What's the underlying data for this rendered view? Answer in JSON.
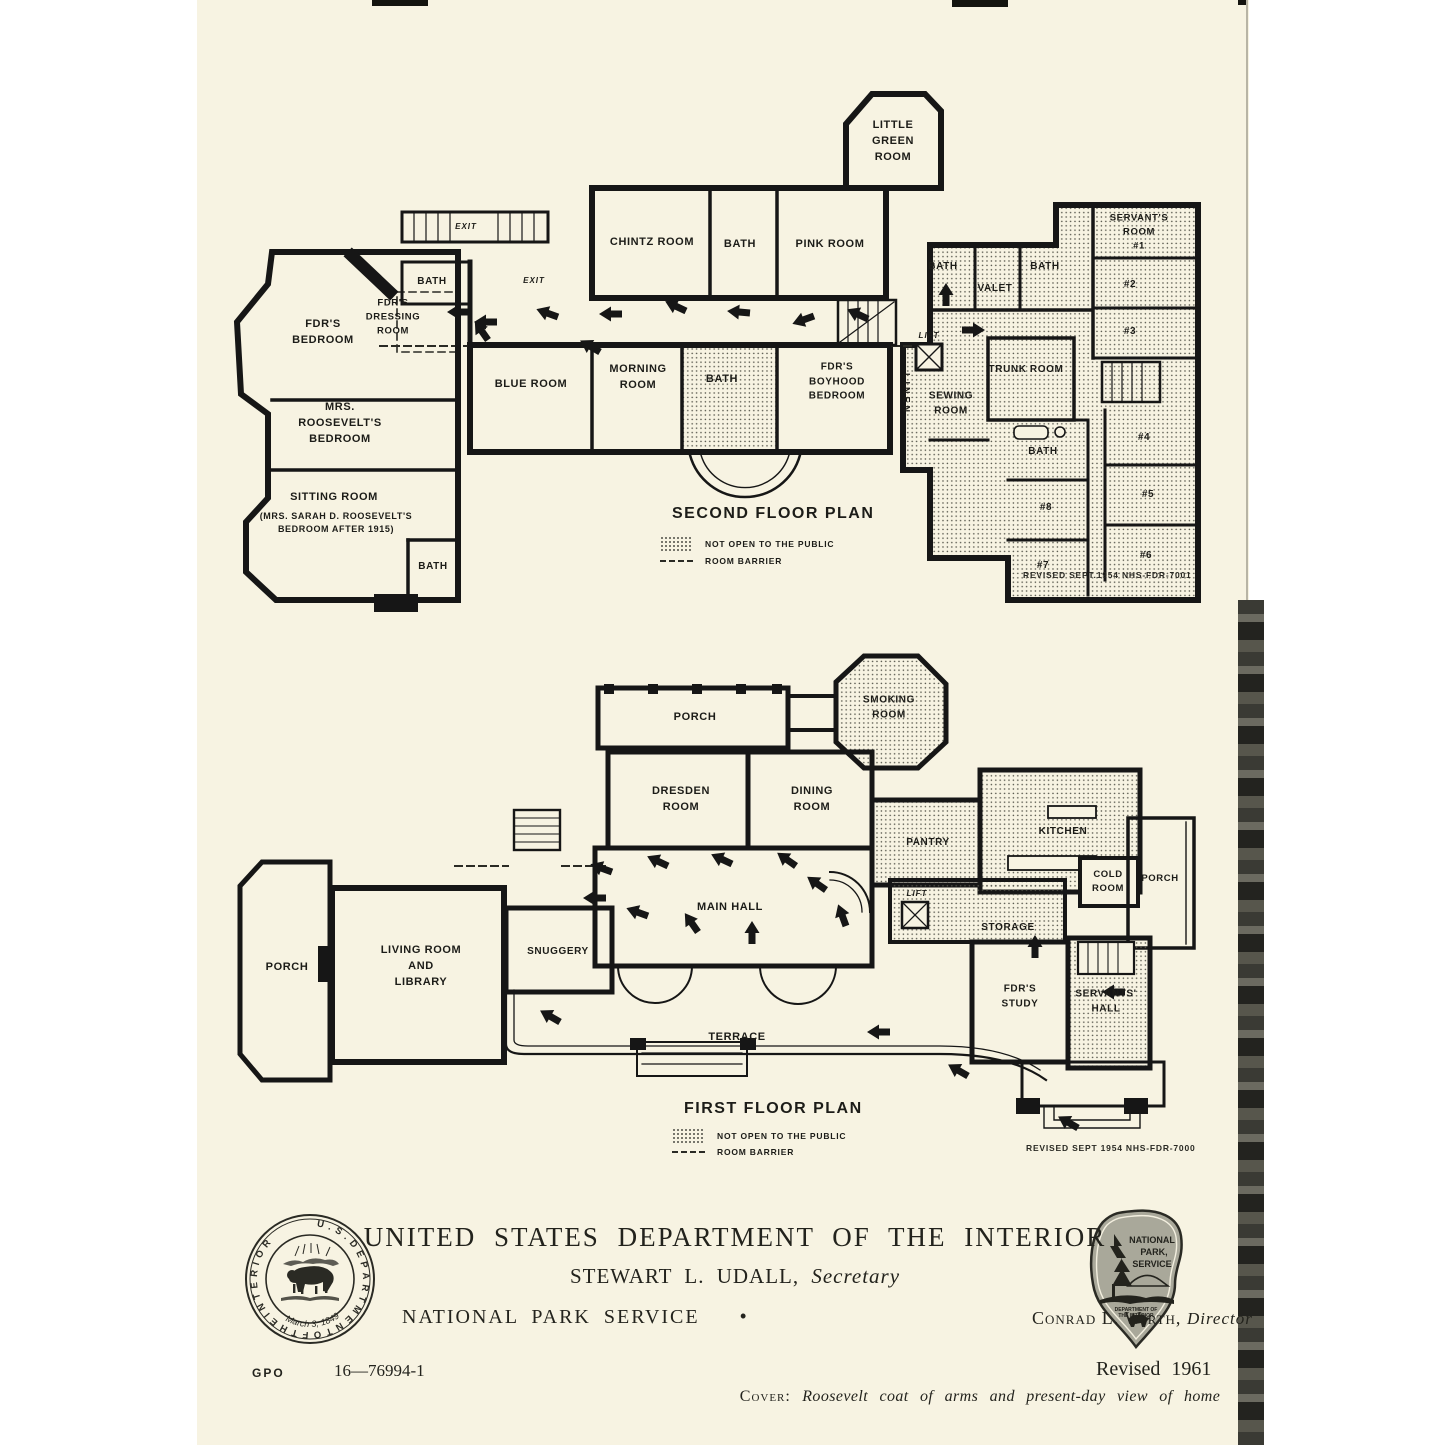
{
  "document": {
    "colors": {
      "paper": "#f7f3e2",
      "ink": "#161616",
      "shade_dot": "#4c4c44",
      "emblem_gray": "#a9a89a"
    },
    "plans": {
      "second": {
        "title": "SECOND FLOOR PLAN",
        "legend_not_open": "NOT OPEN TO THE PUBLIC",
        "legend_room_barrier": "ROOM BARRIER",
        "revision": "REVISED SEPT.1954    NHS-FDR-7001",
        "rooms": [
          {
            "label": "LITTLE\nGREEN\nROOM",
            "x": 893,
            "y": 142
          },
          {
            "label": "CHINTZ ROOM",
            "x": 652,
            "y": 243
          },
          {
            "label": "BATH",
            "x": 740,
            "y": 245
          },
          {
            "label": "PINK ROOM",
            "x": 830,
            "y": 245
          },
          {
            "label": "BATH",
            "x": 943,
            "y": 267,
            "size": 10
          },
          {
            "label": "VALET",
            "x": 995,
            "y": 289,
            "size": 10
          },
          {
            "label": "BATH",
            "x": 1045,
            "y": 267,
            "size": 10
          },
          {
            "label": "SERVANT'S\nROOM\n#1",
            "x": 1139,
            "y": 232,
            "size": 9.5
          },
          {
            "label": "#2",
            "x": 1130,
            "y": 285,
            "size": 10
          },
          {
            "label": "#3",
            "x": 1130,
            "y": 332,
            "size": 10
          },
          {
            "label": "EXIT",
            "x": 466,
            "y": 227,
            "italic": true
          },
          {
            "label": "EXIT",
            "x": 534,
            "y": 281,
            "italic": true
          },
          {
            "label": "BATH",
            "x": 432,
            "y": 282,
            "size": 10
          },
          {
            "label": "FDR'S\nDRESSING\nROOM",
            "x": 393,
            "y": 317,
            "size": 9.5
          },
          {
            "label": "FDR'S\nBEDROOM",
            "x": 323,
            "y": 333
          },
          {
            "label": "BLUE ROOM",
            "x": 531,
            "y": 385
          },
          {
            "label": "MORNING\nROOM",
            "x": 638,
            "y": 378
          },
          {
            "label": "BATH",
            "x": 722,
            "y": 380
          },
          {
            "label": "FDR'S\nBOYHOOD\nBEDROOM",
            "x": 837,
            "y": 382,
            "size": 10
          },
          {
            "label": "LINEN",
            "x": 906,
            "y": 394,
            "size": 9,
            "vertical": true
          },
          {
            "label": "LIFT",
            "x": 929,
            "y": 336,
            "italic": true
          },
          {
            "label": "SEWING\nROOM",
            "x": 951,
            "y": 404,
            "size": 10
          },
          {
            "label": "TRUNK ROOM",
            "x": 1026,
            "y": 370,
            "size": 10
          },
          {
            "label": "BATH",
            "x": 1043,
            "y": 452,
            "size": 10
          },
          {
            "label": "#4",
            "x": 1144,
            "y": 438,
            "size": 10
          },
          {
            "label": "#5",
            "x": 1148,
            "y": 495,
            "size": 10
          },
          {
            "label": "#8",
            "x": 1046,
            "y": 508,
            "size": 10
          },
          {
            "label": "#6",
            "x": 1146,
            "y": 556,
            "size": 10
          },
          {
            "label": "#7",
            "x": 1043,
            "y": 566,
            "size": 10
          },
          {
            "label": "MRS.\nROOSEVELT'S\nBEDROOM",
            "x": 340,
            "y": 424
          },
          {
            "label": "SITTING ROOM",
            "x": 334,
            "y": 498
          },
          {
            "label": "(MRS. SARAH D. ROOSEVELT'S\nBEDROOM AFTER 1915)",
            "x": 336,
            "y": 523,
            "size": 9
          },
          {
            "label": "BATH",
            "x": 433,
            "y": 567,
            "size": 10
          }
        ]
      },
      "first": {
        "title": "FIRST FLOOR PLAN",
        "legend_not_open": "NOT OPEN TO THE PUBLIC",
        "legend_room_barrier": "ROOM BARRIER",
        "revision": "REVISED SEPT 1954   NHS-FDR-7000",
        "rooms": [
          {
            "label": "PORCH",
            "x": 695,
            "y": 718
          },
          {
            "label": "SMOKING\nROOM",
            "x": 889,
            "y": 708,
            "size": 10
          },
          {
            "label": "DRESDEN\nROOM",
            "x": 681,
            "y": 800
          },
          {
            "label": "DINING\nROOM",
            "x": 812,
            "y": 800
          },
          {
            "label": "PANTRY",
            "x": 928,
            "y": 843,
            "size": 10
          },
          {
            "label": "KITCHEN",
            "x": 1063,
            "y": 832,
            "size": 10
          },
          {
            "label": "COLD\nROOM",
            "x": 1108,
            "y": 882,
            "size": 9.5
          },
          {
            "label": "PORCH",
            "x": 1160,
            "y": 879,
            "size": 9.5
          },
          {
            "label": "MAIN HALL",
            "x": 730,
            "y": 908
          },
          {
            "label": "LIFT",
            "x": 917,
            "y": 894,
            "italic": true
          },
          {
            "label": "STORAGE",
            "x": 1008,
            "y": 928,
            "size": 10
          },
          {
            "label": "SNUGGERY",
            "x": 558,
            "y": 952,
            "size": 10
          },
          {
            "label": "LIVING ROOM\nAND\nLIBRARY",
            "x": 421,
            "y": 967
          },
          {
            "label": "PORCH",
            "x": 287,
            "y": 968
          },
          {
            "label": "FDR'S\nSTUDY",
            "x": 1020,
            "y": 997,
            "size": 10
          },
          {
            "label": "SERVANTS'\nHALL",
            "x": 1106,
            "y": 1002,
            "size": 10
          },
          {
            "label": "TERRACE",
            "x": 737,
            "y": 1038
          }
        ]
      }
    },
    "interior_seal": {
      "ring_text": "U . S . D E P A R T M E N T  O F  T H E  I N T E R I O R",
      "date_text": "March 3, 1849",
      "icon": "buffalo-icon"
    },
    "nps_emblem": {
      "line1": "NATIONAL",
      "line2": "PARK,",
      "line3": "SERVICE",
      "dept1": "DEPARTMENT OF",
      "dept2": "THE INTERIOR",
      "icon": "arrowhead-tree-bison-icon"
    },
    "footer": {
      "title": "UNITED STATES DEPARTMENT OF THE INTERIOR",
      "secretary_name": "STEWART L. UDALL,",
      "secretary_title": "Secretary",
      "agency": "NATIONAL PARK SERVICE",
      "bullet": "•",
      "director_name": "Conrad L. Wirth,",
      "director_title": "Director",
      "gpo_label": "GPO",
      "gpo_number": "16—76994-1",
      "revised": "Revised 1961",
      "cover_label": "Cover:",
      "cover_text": "Roosevelt coat of arms and present-day view of home"
    }
  }
}
